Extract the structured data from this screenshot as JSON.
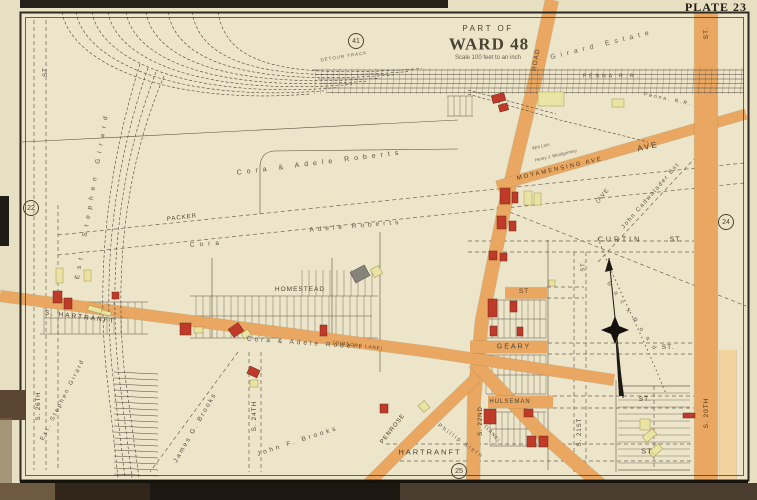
{
  "page": {
    "plate_title": "PLATE 23"
  },
  "map": {
    "title_block": {
      "part_of": "PART OF",
      "ward": "WARD 48",
      "scale": "Scale 100 feet to an inch"
    },
    "colors": {
      "paper": "#e7dfc2",
      "map_bg": "#ece5ca",
      "road_fill": "#eaa761",
      "road_light": "#f2d29d",
      "road_edge": "#9c7338",
      "building_red": "#bf3a28",
      "building_yellow": "#e9e3a4",
      "building_gray": "#85837a",
      "line": "#4a443a",
      "text": "#4a4434",
      "faint_text": "#6b6250"
    },
    "adjacent_plate_refs": [
      {
        "number": "41",
        "x": 356,
        "y": 41
      },
      {
        "number": "22",
        "x": 31,
        "y": 208
      },
      {
        "number": "24",
        "x": 726,
        "y": 222
      },
      {
        "number": "25",
        "x": 459,
        "y": 471
      }
    ],
    "roads": [
      {
        "id": "penrose-ferry-road",
        "pts": [
          [
            552,
            0
          ],
          [
            534,
            85
          ],
          [
            504,
            210
          ],
          [
            482,
            320
          ],
          [
            474,
            400
          ],
          [
            473,
            500
          ]
        ],
        "w": 13
      },
      {
        "id": "lane-southeast",
        "pts": [
          [
            474,
            362
          ],
          [
            540,
            432
          ],
          [
            618,
            500
          ]
        ],
        "w": 13
      },
      {
        "id": "penrose-southwest",
        "pts": [
          [
            476,
            378
          ],
          [
            420,
            432
          ],
          [
            352,
            500
          ]
        ],
        "w": 11
      },
      {
        "id": "hartranft-diagonal",
        "pts": [
          [
            0,
            296
          ],
          [
            200,
            322
          ],
          [
            430,
            352
          ],
          [
            614,
            380
          ]
        ],
        "w": 11
      },
      {
        "id": "moyamensing-ave",
        "pts": [
          [
            746,
            114
          ],
          [
            497,
            186
          ]
        ],
        "w": 10
      },
      {
        "id": "s-20th-st",
        "pts": [
          [
            706,
            12
          ],
          [
            706,
            481
          ]
        ],
        "w": 23
      },
      {
        "id": "s-20th-st-light",
        "pts": [
          [
            728,
            350
          ],
          [
            728,
            481
          ]
        ],
        "w": 16,
        "light": true
      },
      {
        "id": "geary-st-band",
        "pts": [
          [
            470,
            347
          ],
          [
            548,
            347
          ]
        ],
        "w": 12
      },
      {
        "id": "st-band",
        "pts": [
          [
            505,
            293
          ],
          [
            547,
            293
          ]
        ],
        "w": 11
      },
      {
        "id": "hulseman-st-band",
        "pts": [
          [
            488,
            402
          ],
          [
            553,
            402
          ]
        ],
        "w": 12
      }
    ],
    "labels": [
      {
        "id": "part-of",
        "text": "PART OF",
        "x": 488,
        "y": 29,
        "rot": 0,
        "fs": 8,
        "ls": 2.5,
        "bold": false
      },
      {
        "id": "ward-title",
        "text": "WARD 48",
        "x": 489,
        "y": 44,
        "rot": 0,
        "fs": 17,
        "ls": 1,
        "bold": true,
        "serif": true
      },
      {
        "id": "scale-note",
        "text": "Scale 100 feet to an inch",
        "x": 488,
        "y": 58,
        "rot": 0,
        "fs": 6,
        "ls": 0,
        "c": "#6b6250"
      },
      {
        "id": "road-name",
        "text": "ROAD",
        "x": 537,
        "y": 60,
        "rot": -80,
        "fs": 6.5,
        "ls": 1
      },
      {
        "id": "girard-estate",
        "text": "Girard   Estate",
        "x": 602,
        "y": 45,
        "rot": -14,
        "fs": 7,
        "ls": 5,
        "c": "#6b6250"
      },
      {
        "id": "penna-rr-main",
        "text": "PENNA   R.R.",
        "x": 612,
        "y": 77,
        "rot": 0,
        "fs": 5,
        "ls": 3,
        "c": "#55503f"
      },
      {
        "id": "detour-track",
        "text": "DETOUR  TRACK",
        "x": 344,
        "y": 57,
        "rot": -9,
        "fs": 4.5,
        "ls": 1,
        "c": "#6b6250"
      },
      {
        "id": "penna-rr-branch",
        "text": "Penna. R.R.",
        "x": 668,
        "y": 100,
        "rot": 12,
        "fs": 5,
        "ls": 2,
        "c": "#55503f"
      },
      {
        "id": "moyamensing-ave",
        "text": "MOYAMENSING   AVE",
        "x": 560,
        "y": 169,
        "rot": -13,
        "fs": 6,
        "ls": 2,
        "c": "#4a3a22"
      },
      {
        "id": "ave-big",
        "text": "AVE",
        "x": 648,
        "y": 147,
        "rot": -13,
        "fs": 8,
        "ls": 2,
        "c": "#4a3a22"
      },
      {
        "id": "wm-linn",
        "text": "Wm Linn",
        "x": 541,
        "y": 147,
        "rot": -13,
        "fs": 4.5,
        "ls": 0,
        "c": "#6b6250"
      },
      {
        "id": "montgomery",
        "text": "Henry J. Montgomery",
        "x": 556,
        "y": 156,
        "rot": -13,
        "fs": 4.5,
        "ls": 0,
        "c": "#6b6250"
      },
      {
        "id": "cadwalader",
        "text": "John Cadwalader Est",
        "x": 651,
        "y": 196,
        "rot": -49,
        "fs": 6,
        "ls": 1.5,
        "c": "#5a5345"
      },
      {
        "id": "ave-paren",
        "text": "(AVE",
        "x": 603,
        "y": 196,
        "rot": -50,
        "fs": 6,
        "ls": 1,
        "c": "#5a5345"
      },
      {
        "id": "curtin",
        "text": "CURTIN",
        "x": 620,
        "y": 240,
        "rot": 0,
        "fs": 7,
        "ls": 3
      },
      {
        "id": "curtin-st",
        "text": "ST.",
        "x": 676,
        "y": 240,
        "rot": 0,
        "fs": 7,
        "ls": 1
      },
      {
        "id": "st-mid",
        "text": "ST",
        "x": 524,
        "y": 292,
        "rot": 0,
        "fs": 6.5,
        "ls": 1
      },
      {
        "id": "geary",
        "text": "GEARY",
        "x": 514,
        "y": 347,
        "rot": 0,
        "fs": 7,
        "ls": 2
      },
      {
        "id": "geary-st",
        "text": "ST.",
        "x": 668,
        "y": 348,
        "rot": 0,
        "fs": 6.5,
        "ls": 1
      },
      {
        "id": "hulseman",
        "text": "HULSEMAN",
        "x": 510,
        "y": 402,
        "rot": 0,
        "fs": 6,
        "ls": 1
      },
      {
        "id": "hulseman-st",
        "text": "ST.",
        "x": 645,
        "y": 400,
        "rot": 0,
        "fs": 6.5,
        "ls": 1
      },
      {
        "id": "hartranft-bottom",
        "text": "HARTRANFT",
        "x": 430,
        "y": 452,
        "rot": 0,
        "fs": 7.5,
        "ls": 2
      },
      {
        "id": "hartranft-b-st",
        "text": "ST.",
        "x": 648,
        "y": 451,
        "rot": 0,
        "fs": 7.5,
        "ls": 1
      },
      {
        "id": "hartranft-diag",
        "text": "S.  HARTRANFT",
        "x": 80,
        "y": 318,
        "rot": 7,
        "fs": 6.5,
        "ls": 2,
        "c": "#4a3a22"
      },
      {
        "id": "gibsons-lane",
        "text": "(GIBSONS LANE)",
        "x": 358,
        "y": 346,
        "rot": 7,
        "fs": 4.5,
        "ls": 1,
        "c": "#4a3a22"
      },
      {
        "id": "lane-paren",
        "text": "(LANE)",
        "x": 492,
        "y": 434,
        "rot": 48,
        "fs": 4.5,
        "ls": 1,
        "c": "#4a3a22"
      },
      {
        "id": "penrose",
        "text": "PENROSE",
        "x": 393,
        "y": 429,
        "rot": -52,
        "fs": 6,
        "ls": 1,
        "c": "#4a3a22"
      },
      {
        "id": "homestead",
        "text": "HOMESTEAD",
        "x": 300,
        "y": 290,
        "rot": 0,
        "fs": 6.5,
        "ls": 1
      },
      {
        "id": "packer",
        "text": "PACKER",
        "x": 182,
        "y": 218,
        "rot": -7,
        "fs": 6,
        "ls": 1
      },
      {
        "id": "cora-adele-1",
        "text": "Cora  &  Adele  Roberts",
        "x": 320,
        "y": 163,
        "rot": -7,
        "fs": 7,
        "ls": 5,
        "c": "#5a5345"
      },
      {
        "id": "adele-roberts-2",
        "text": "Adele  Roberts",
        "x": 356,
        "y": 227,
        "rot": -5,
        "fs": 6.5,
        "ls": 4,
        "c": "#5a5345"
      },
      {
        "id": "cora-2",
        "text": "Cora",
        "x": 207,
        "y": 245,
        "rot": -4,
        "fs": 6.5,
        "ls": 5,
        "c": "#5a5345"
      },
      {
        "id": "cora-adele-3",
        "text": "Cora  &  Adele  Robert",
        "x": 305,
        "y": 344,
        "rot": 4,
        "fs": 6.5,
        "ls": 3,
        "c": "#5a5345"
      },
      {
        "id": "est-girard-top",
        "text": "Est. Stephen Girard",
        "x": 93,
        "y": 195,
        "rot": -80,
        "fs": 6.5,
        "ls": 6,
        "c": "#5a5345"
      },
      {
        "id": "est-girard-bot",
        "text": "Est. Stephen Girard",
        "x": 63,
        "y": 400,
        "rot": -63,
        "fs": 6,
        "ls": 2,
        "c": "#5a5345"
      },
      {
        "id": "james-brooks",
        "text": "James G. Brooks",
        "x": 196,
        "y": 428,
        "rot": -60,
        "fs": 6.5,
        "ls": 2,
        "c": "#5a5345"
      },
      {
        "id": "john-brooks",
        "text": "John F. Brooks",
        "x": 298,
        "y": 442,
        "rot": -18,
        "fs": 6.5,
        "ls": 3,
        "c": "#5a5345"
      },
      {
        "id": "phillip-siern",
        "text": "Phillip Siern",
        "x": 460,
        "y": 442,
        "rot": 36,
        "fs": 5.5,
        "ls": 2,
        "c": "#5a5345"
      },
      {
        "id": "back-road",
        "text": "B a c k    R o a d",
        "x": 632,
        "y": 317,
        "rot": 55,
        "fs": 6,
        "ls": 3,
        "c": "#6b6250"
      },
      {
        "id": "s-26th",
        "text": "S. 26TH",
        "x": 39,
        "y": 406,
        "rot": -90,
        "fs": 6,
        "ls": 1
      },
      {
        "id": "st-left-top",
        "text": "ST",
        "x": 46,
        "y": 72,
        "rot": -90,
        "fs": 6,
        "ls": 1
      },
      {
        "id": "s-24th",
        "text": "S. 24TH",
        "x": 255,
        "y": 416,
        "rot": -90,
        "fs": 6.5,
        "ls": 1
      },
      {
        "id": "s-22nd",
        "text": "S. 22ND",
        "x": 481,
        "y": 421,
        "rot": -90,
        "fs": 6,
        "ls": 1,
        "c": "#4a3a22"
      },
      {
        "id": "s-21st",
        "text": "S. 21ST",
        "x": 580,
        "y": 432,
        "rot": -90,
        "fs": 6,
        "ls": 1
      },
      {
        "id": "s-21st-st",
        "text": "ST.",
        "x": 584,
        "y": 266,
        "rot": -90,
        "fs": 5.5,
        "ls": 1
      },
      {
        "id": "s-20th",
        "text": "S. 20TH",
        "x": 707,
        "y": 413,
        "rot": -90,
        "fs": 6.5,
        "ls": 1,
        "c": "#4a3a22"
      },
      {
        "id": "st-top-right",
        "text": "ST.",
        "x": 707,
        "y": 33,
        "rot": -90,
        "fs": 6.5,
        "ls": 1,
        "c": "#4a3a22"
      }
    ],
    "buildings": [
      [
        492,
        94,
        13,
        8,
        "r",
        -15
      ],
      [
        499,
        104,
        9,
        7,
        "r",
        -15
      ],
      [
        500,
        188,
        10,
        16,
        "r",
        0
      ],
      [
        512,
        192,
        6,
        11,
        "r",
        0
      ],
      [
        497,
        216,
        9,
        13,
        "r",
        0
      ],
      [
        509,
        221,
        7,
        10,
        "r",
        0
      ],
      [
        489,
        251,
        8,
        9,
        "r",
        0
      ],
      [
        500,
        253,
        7,
        8,
        "r",
        0
      ],
      [
        488,
        299,
        9,
        18,
        "r",
        0
      ],
      [
        510,
        301,
        7,
        11,
        "r",
        0
      ],
      [
        490,
        326,
        7,
        10,
        "r",
        0
      ],
      [
        517,
        327,
        6,
        9,
        "r",
        0
      ],
      [
        53,
        291,
        9,
        12,
        "r",
        0
      ],
      [
        64,
        298,
        8,
        11,
        "r",
        0
      ],
      [
        112,
        292,
        7,
        7,
        "r",
        0
      ],
      [
        180,
        323,
        11,
        12,
        "r",
        0
      ],
      [
        230,
        325,
        12,
        10,
        "r",
        -35
      ],
      [
        320,
        325,
        7,
        11,
        "r",
        0
      ],
      [
        248,
        368,
        11,
        8,
        "r",
        25
      ],
      [
        380,
        404,
        8,
        9,
        "r",
        0
      ],
      [
        484,
        409,
        12,
        15,
        "r",
        0
      ],
      [
        524,
        409,
        9,
        8,
        "r",
        0
      ],
      [
        527,
        436,
        9,
        11,
        "r",
        0
      ],
      [
        539,
        436,
        9,
        11,
        "r",
        0
      ],
      [
        683,
        413,
        12,
        5,
        "r",
        0
      ],
      [
        538,
        92,
        26,
        14,
        "y",
        0
      ],
      [
        612,
        99,
        12,
        8,
        "y",
        0
      ],
      [
        524,
        191,
        8,
        14,
        "y",
        0
      ],
      [
        534,
        193,
        7,
        12,
        "y",
        0
      ],
      [
        549,
        280,
        6,
        6,
        "y",
        0
      ],
      [
        56,
        268,
        7,
        15,
        "y",
        0
      ],
      [
        84,
        270,
        7,
        11,
        "y",
        0
      ],
      [
        88,
        307,
        14,
        5,
        "y",
        15
      ],
      [
        101,
        311,
        10,
        4,
        "y",
        15
      ],
      [
        194,
        327,
        9,
        6,
        "y",
        0
      ],
      [
        242,
        331,
        8,
        6,
        "y",
        -35
      ],
      [
        372,
        267,
        9,
        9,
        "y",
        -30
      ],
      [
        250,
        380,
        8,
        7,
        "y",
        0
      ],
      [
        420,
        402,
        8,
        9,
        "y",
        -40
      ],
      [
        640,
        419,
        10,
        11,
        "y",
        0
      ],
      [
        643,
        432,
        13,
        7,
        "y",
        -40
      ],
      [
        649,
        447,
        13,
        7,
        "y",
        -40
      ],
      [
        352,
        268,
        16,
        12,
        "g",
        -28
      ]
    ],
    "compass": {
      "x": 615,
      "y": 330
    }
  }
}
